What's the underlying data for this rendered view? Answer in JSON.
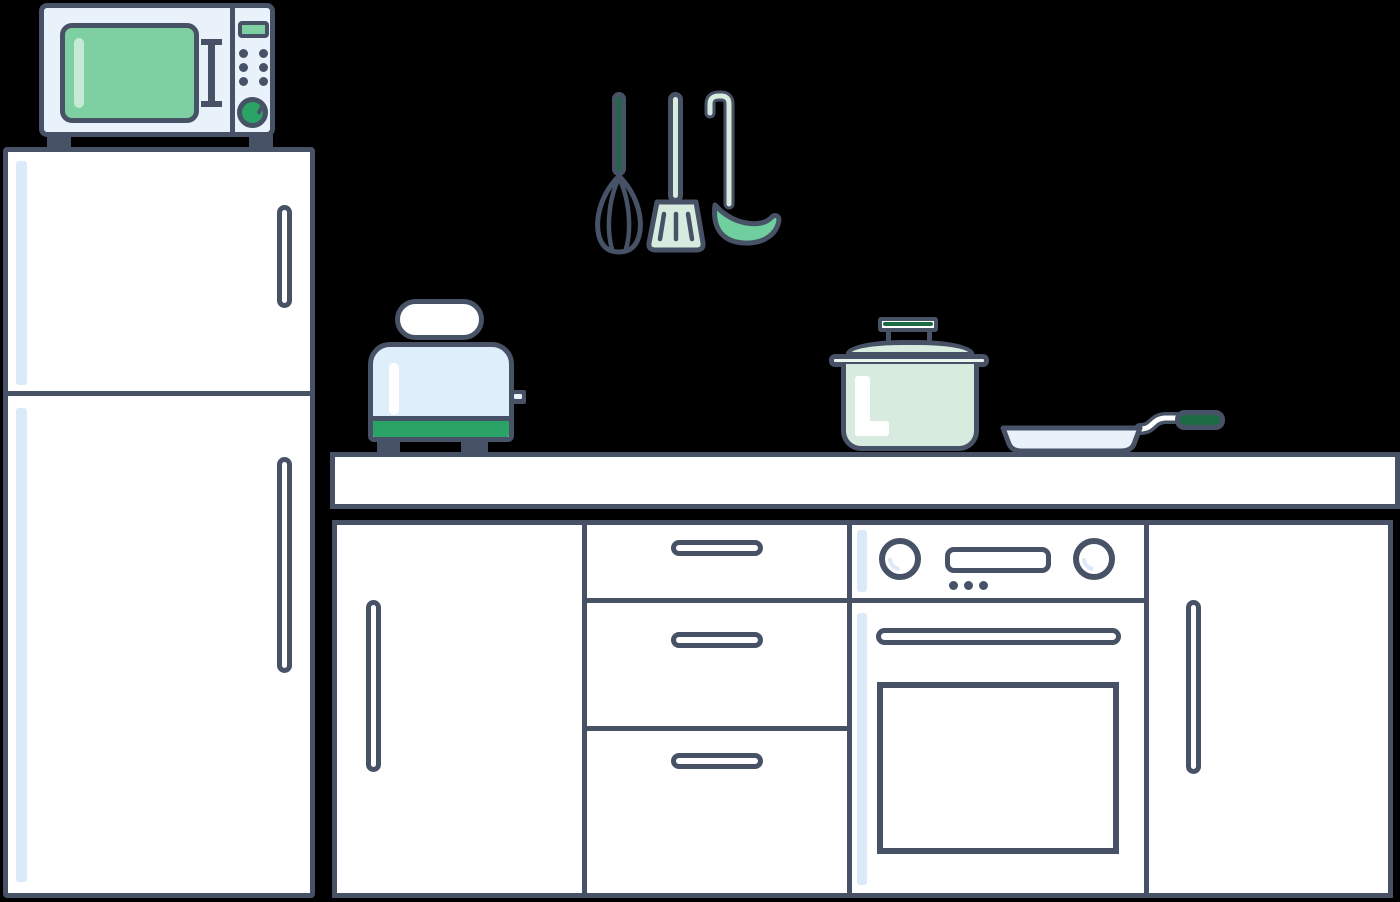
{
  "scene": {
    "title": "flat kitchen illustration",
    "background": "#000000",
    "object_count": 8
  },
  "palette": {
    "outline": "#475266",
    "white": "#ffffff",
    "blue_pale": "#e9f1fa",
    "blue": "#deeefa",
    "strip": "#dbe9f8",
    "green_window": "#7ed0a2",
    "green_bright": "#2ba266",
    "green_dark": "#1d6b45",
    "green_medium": "#6fcf9e",
    "mint": "#d7ecdf",
    "mint_rim": "#eaf5ee",
    "bg": "#000000"
  },
  "objects": {
    "microwave": {
      "label": "microwave oven",
      "buttons": 6,
      "has_dial": true,
      "has_display": true,
      "feet": 2
    },
    "fridge": {
      "label": "refrigerator",
      "doors": 2,
      "handles": 2
    },
    "utensils": {
      "label": "hanging utensils",
      "items": [
        "whisk",
        "spatula",
        "ladle"
      ]
    },
    "toaster": {
      "label": "toaster with bread slice",
      "feet": 2,
      "has_lever": true
    },
    "pot": {
      "label": "cooking pot with lid"
    },
    "pan": {
      "label": "frying pan"
    },
    "countertop": {
      "label": "kitchen countertop"
    },
    "cabinets": {
      "label": "lower cabinet run",
      "sections": [
        "left door",
        "drawer stack",
        "oven",
        "right door"
      ],
      "drawers": 3,
      "oven": {
        "knobs": 2,
        "display_dots": 3,
        "has_window": true,
        "has_handle": true
      }
    }
  }
}
